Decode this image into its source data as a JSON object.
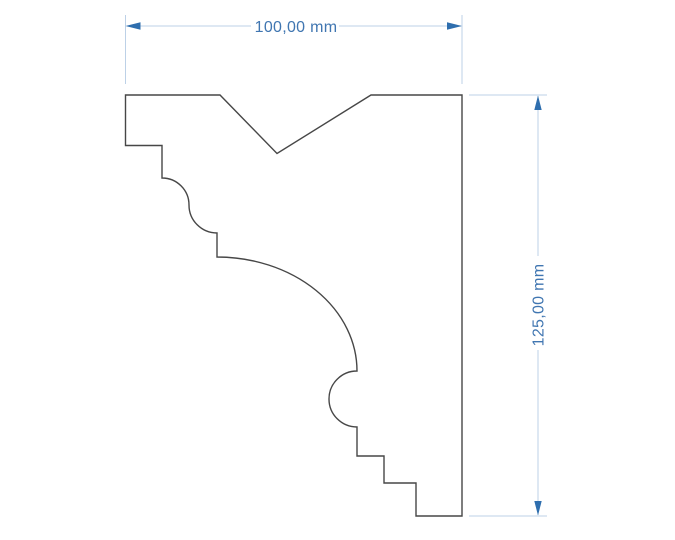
{
  "colors": {
    "background": "#ffffff",
    "outline": "#474747",
    "dim-line": "#bdd1e7",
    "dim-arrow": "#2e6eae",
    "dim-text": "#4076b1"
  },
  "drawing": {
    "description": "molding profile cross-section with V-notch, ogee, cove, torus bead and steps",
    "profile_path": "M 125.5 95 L 220 95 L 277 153.5 L 371 95 L 462 95 L 462 516 L 416 516 L 416 483 L 384 483 L 384 456 L 357 456 L 357 427 A 28 28 0 0 1 357 371 A 140 114 0 0 0 217 257 L 217 233 A 28 28 0 0 1 189 205 A 27 27 0 0 0 162 178 L 162 145.5 L 125.5 145.5 Z"
  },
  "dimensions": {
    "horizontal": {
      "label": "100,00 mm",
      "value_mm": "100,00",
      "unit": "mm",
      "line_path": "M 127 26 H 251 M 339 26 H 461",
      "extension_path": "M 125.5 15 V 84 M 462 15 V 84",
      "arrow_left_path": "M 125.5 26 L 140.5 22.3 L 140.5 29.7 Z",
      "arrow_right_path": "M 462 26 L 447 22.3 L 447 29.7 Z"
    },
    "vertical": {
      "label": "125,00 mm",
      "value_mm": "125,00",
      "unit": "mm",
      "line_path": "M 538 96 V 256 M 538 350 V 515",
      "extension_path": "M 469 95 H 547 M 469 516 H 547",
      "arrow_up_path": "M 538 95.5 L 534.3 110 L 541.7 110 Z",
      "arrow_down_path": "M 538 515.5 L 534.3 501 L 541.7 501 Z",
      "label_transform": "rotate(-90 538 305)"
    }
  }
}
